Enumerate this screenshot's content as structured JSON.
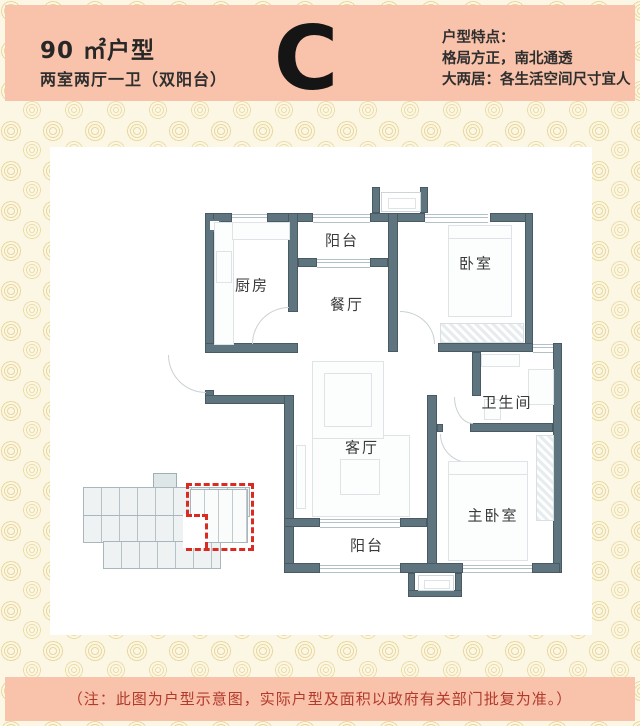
{
  "header": {
    "area_label": "90 ㎡户型",
    "layout_label": "两室两厅一卫（双阳台）",
    "unit_letter": "C",
    "features": {
      "title": "户型特点：",
      "line1": "格局方正，南北通透",
      "line2": "大两居：各生活空间尺寸宜人"
    }
  },
  "floorplan": {
    "rooms": {
      "north_balcony": "阳台",
      "kitchen": "厨房",
      "dining": "餐厅",
      "bedroom": "卧室",
      "bathroom": "卫生间",
      "living": "客厅",
      "master_bedroom": "主卧室",
      "south_balcony": "阳台"
    }
  },
  "footer": {
    "note": "（注：此图为户型示意图，实际户型及面积以政府有关部门批复为准。）"
  },
  "colors": {
    "band_salmon": "#f9c2ab",
    "wall_slate": "#5e747e",
    "highlight_red": "#d92b21",
    "note_red": "#b23a2c",
    "background_cream": "#fbf7e4"
  }
}
